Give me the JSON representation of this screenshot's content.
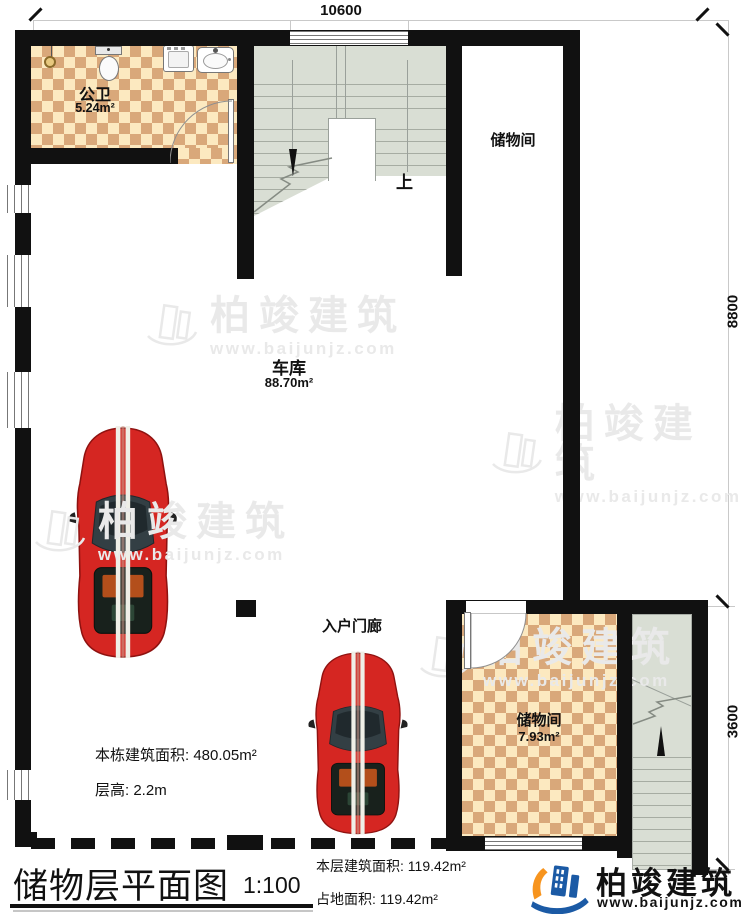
{
  "dimensions": {
    "top": "10600",
    "right_upper": "8800",
    "right_lower": "3600"
  },
  "rooms": {
    "bathroom": {
      "name": "公卫",
      "area": "5.24m²"
    },
    "storage_top": {
      "name": "储物间"
    },
    "garage": {
      "name": "车库",
      "area": "88.70m²"
    },
    "porch": {
      "name": "入户门廊"
    },
    "storage_bottom": {
      "name": "储物间",
      "area": "7.93m²"
    }
  },
  "stairs": {
    "up_label": "上"
  },
  "notes": {
    "building_area_label": "本栋建筑面积:",
    "building_area_value": "480.05m²",
    "floor_height_label": "层高:",
    "floor_height_value": "2.2m"
  },
  "title_block": {
    "title": "储物层平面图",
    "scale": "1:100",
    "floor_area_label": "本层建筑面积:",
    "floor_area_value": "119.42m²",
    "land_area_label": "占地面积:",
    "land_area_value": "119.42m²"
  },
  "branding": {
    "company": "柏竣建筑",
    "website": "www.baijunjz.com"
  },
  "watermark": {
    "company": "柏竣建筑",
    "website": "www.baijunjz.com"
  },
  "colors": {
    "wall": "#111111",
    "tile_light": "#fce9c0",
    "tile_dark": "#d9a87a",
    "stair_fill": "#d9ded4",
    "logo_blue": "#1b5aa5",
    "logo_orange": "#f7941e",
    "car_red": "#d52622",
    "watermark_gray": "#e9e9e9"
  }
}
